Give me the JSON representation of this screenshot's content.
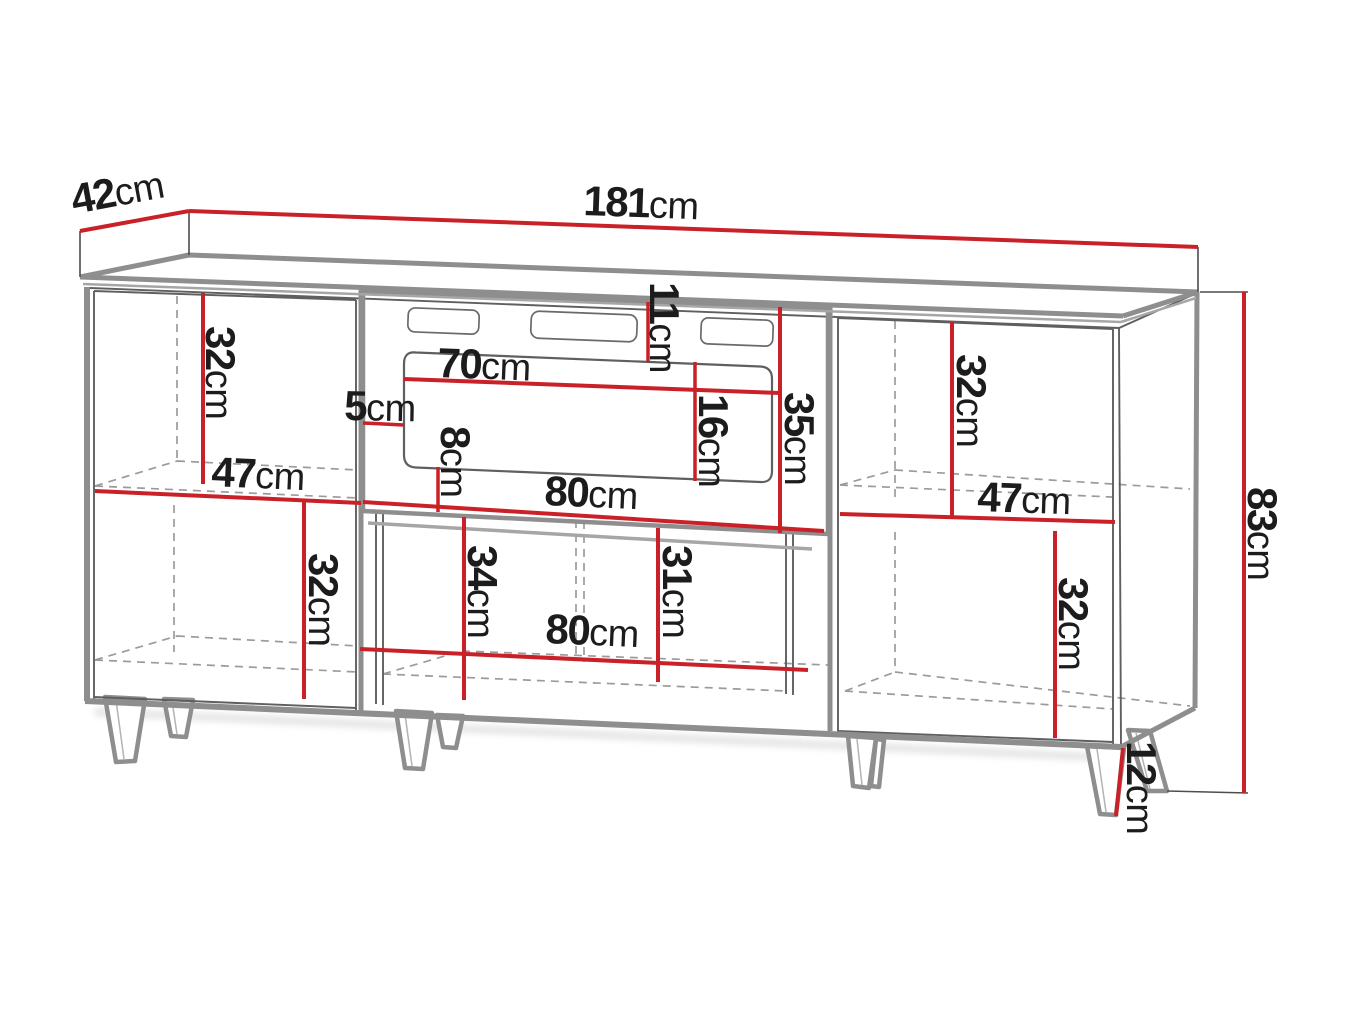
{
  "colors": {
    "dimension": "#c92127",
    "outline": "#8e8e8e",
    "detail": "#5f5f5f",
    "hidden": "#9b9b9b",
    "text": "#1c1c1c",
    "background": "#ffffff"
  },
  "labels": {
    "depth": {
      "num": "42",
      "unit": "cm"
    },
    "width": {
      "num": "181",
      "unit": "cm"
    },
    "total_height": {
      "num": "83",
      "unit": "cm"
    },
    "leg_height": {
      "num": "12",
      "unit": "cm"
    },
    "left_upper_compartment_height": {
      "num": "32",
      "unit": "cm"
    },
    "left_compartment_width": {
      "num": "47",
      "unit": "cm"
    },
    "left_lower_compartment_height": {
      "num": "32",
      "unit": "cm"
    },
    "niche_side_inset": {
      "num": "5",
      "unit": "cm"
    },
    "niche_top_offset": {
      "num": "11",
      "unit": "cm"
    },
    "insert_width": {
      "num": "70",
      "unit": "cm"
    },
    "insert_opening_height": {
      "num": "16",
      "unit": "cm"
    },
    "niche_inner_height": {
      "num": "35",
      "unit": "cm"
    },
    "insert_bottom_offset": {
      "num": "8",
      "unit": "cm"
    },
    "niche_width": {
      "num": "80",
      "unit": "cm"
    },
    "middle_left_height": {
      "num": "34",
      "unit": "cm"
    },
    "middle_right_height": {
      "num": "31",
      "unit": "cm"
    },
    "middle_width": {
      "num": "80",
      "unit": "cm"
    },
    "right_compartment_width": {
      "num": "47",
      "unit": "cm"
    },
    "right_upper_compartment_height": {
      "num": "32",
      "unit": "cm"
    },
    "right_lower_compartment_height": {
      "num": "32",
      "unit": "cm"
    }
  }
}
